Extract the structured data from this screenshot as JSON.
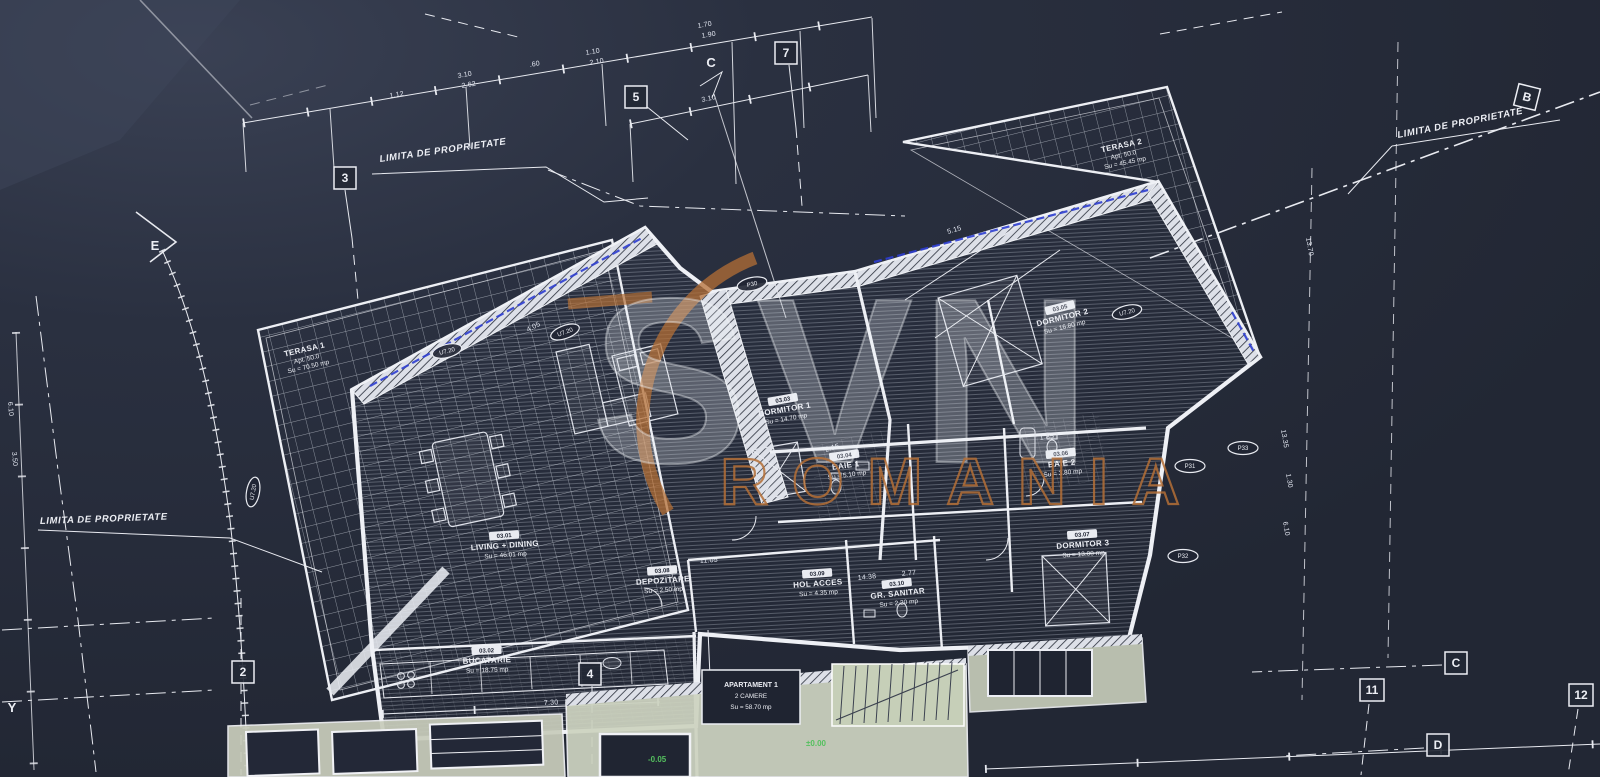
{
  "meta": {
    "background_color": "#252a37",
    "line_color": "#e8eaf0",
    "accent_orange": "#b46f36",
    "accent_blue": "#2e3ed0",
    "accent_green": "#54c05e"
  },
  "watermark": {
    "brand": "SVN",
    "region": "ROMANIA"
  },
  "property": {
    "label": "LIMITA DE PROPRIETATE"
  },
  "grid_markers": [
    {
      "label": "3"
    },
    {
      "label": "5"
    },
    {
      "label": "7"
    },
    {
      "label": "C"
    },
    {
      "label": "B"
    },
    {
      "label": "E"
    },
    {
      "label": "2"
    },
    {
      "label": "4"
    },
    {
      "label": "11"
    },
    {
      "label": "12"
    },
    {
      "label": "C"
    },
    {
      "label": "D"
    },
    {
      "label": "Y"
    }
  ],
  "rooms": [
    {
      "name": "TERASA 1",
      "line2": "Apt. 50.0",
      "area": "Su = 70.50 mp"
    },
    {
      "name": "TERASA 2",
      "line2": "Apt. 50.0",
      "area": "Su = 45.45 mp"
    },
    {
      "code": "03.01",
      "name": "LIVING + DINING",
      "area": "Su = 46.01 mp"
    },
    {
      "code": "03.02",
      "name": "BUCATARIE",
      "area": "Su = 18.75 mp"
    },
    {
      "code": "03.03",
      "name": "DORMITOR 1",
      "area": "Su = 14.70 mp"
    },
    {
      "code": "03.04",
      "name": "BAIE 1",
      "area": "Su = 5.10 mp"
    },
    {
      "code": "03.05",
      "name": "DORMITOR 2",
      "area": "Su = 16.80 mp"
    },
    {
      "code": "03.06",
      "name": "BAIE 2",
      "area": "Su = 3.80 mp"
    },
    {
      "code": "03.07",
      "name": "DORMITOR 3",
      "area": "Su = 13.00 mp"
    },
    {
      "code": "03.08",
      "name": "DEPOZITARE",
      "area": "Su = 2.50 mp"
    },
    {
      "code": "03.09",
      "name": "HOL ACCES",
      "area": "Su = 4.35 mp"
    },
    {
      "code": "03.10",
      "name": "GR. SANITAR",
      "area": "Su = 2.20 mp"
    }
  ],
  "tags": {
    "p30": "P30",
    "p31": "P31",
    "p32": "P32",
    "p33": "P33",
    "u": "U7.20"
  },
  "dimensions": [
    "1.12",
    "3.10",
    "2.62",
    ".60",
    "1.10",
    "2.10",
    "1.70",
    "1.90",
    "3.10",
    "7.30",
    "13.70",
    "13.35",
    "1.30",
    "6.10",
    "6.10",
    "3.50",
    "5.15",
    "3.85",
    "4.05",
    "2.15",
    "1.85",
    "14.38",
    "2.77",
    "11.05"
  ],
  "apartment_block": {
    "line1": "APARTAMENT 1",
    "line2": "2 CAMERE",
    "line3": "Su = 58.70 mp"
  },
  "levels": {
    "a": "±0.00",
    "b": "-0.05"
  }
}
